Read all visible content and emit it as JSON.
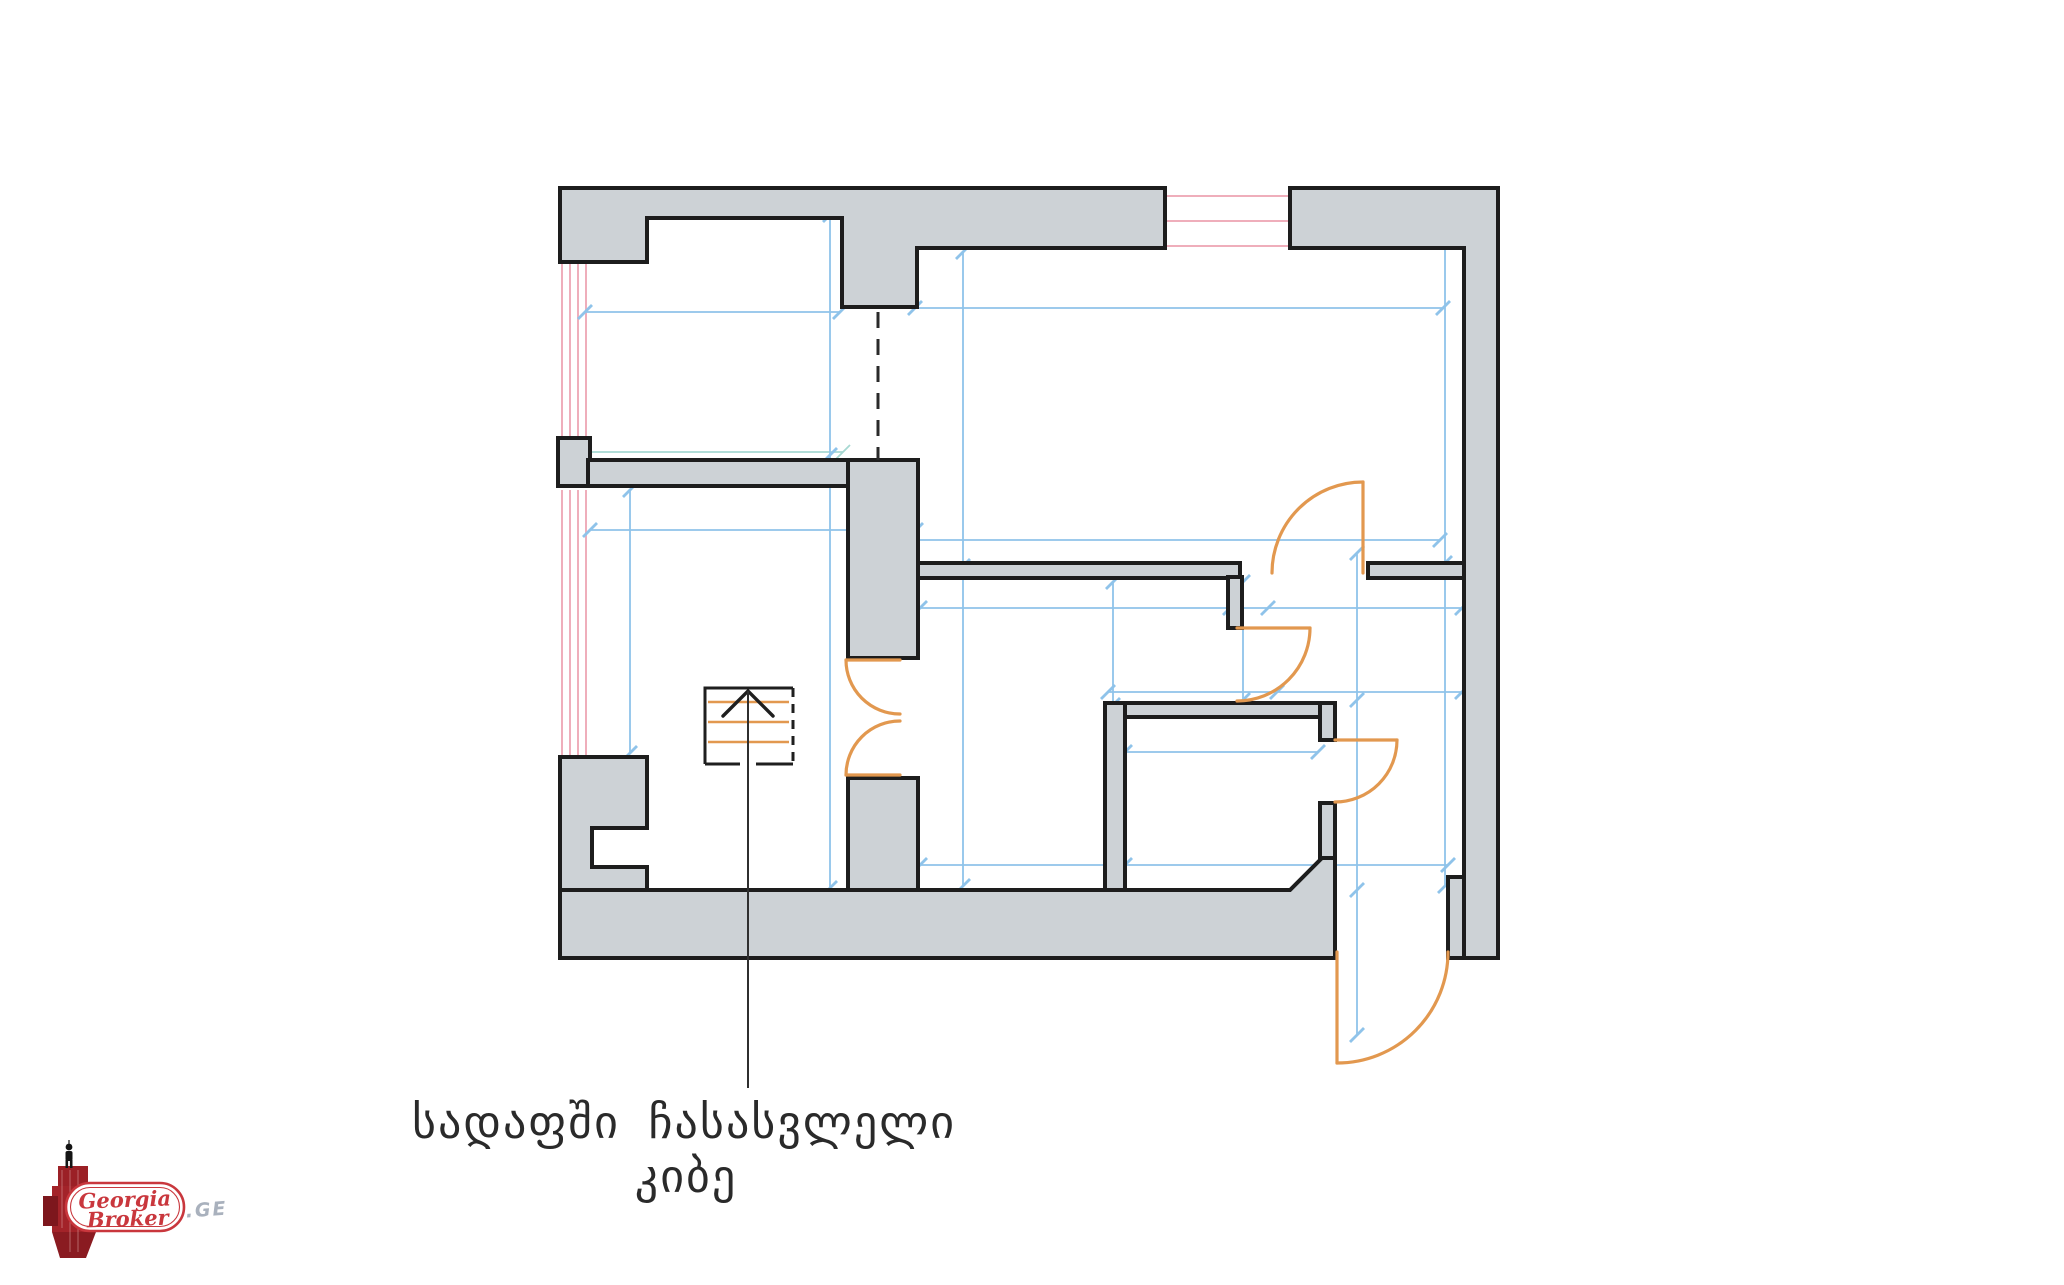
{
  "page": {
    "background_color": "#ffffff"
  },
  "plan": {
    "type": "architectural-floor-plan-scan",
    "wall_fill_color": "#cdd2d6",
    "wall_outline_color": "#1d1d1d",
    "dimension_line_color": "#8fc3ea",
    "dimension_alt_color": "#a6d8d2",
    "window_line_color": "#efaebb",
    "door_swing_color": "#e2984f",
    "stair_symbol": "stair-run-with-up-arrow",
    "door_count": 6,
    "window_count": 3
  },
  "caption": {
    "line1": "სადაფში ჩასასვლელი",
    "line2": "კიბე",
    "color": "#2a2a2a"
  },
  "logo": {
    "brand_word1": "Georgia",
    "brand_word2": "Broker",
    "domain_suffix": ".GE",
    "brand_color": "#c9373d",
    "suffix_color": "#a9b1bd",
    "building_color": "#9b2026",
    "person_color": "#141414"
  }
}
